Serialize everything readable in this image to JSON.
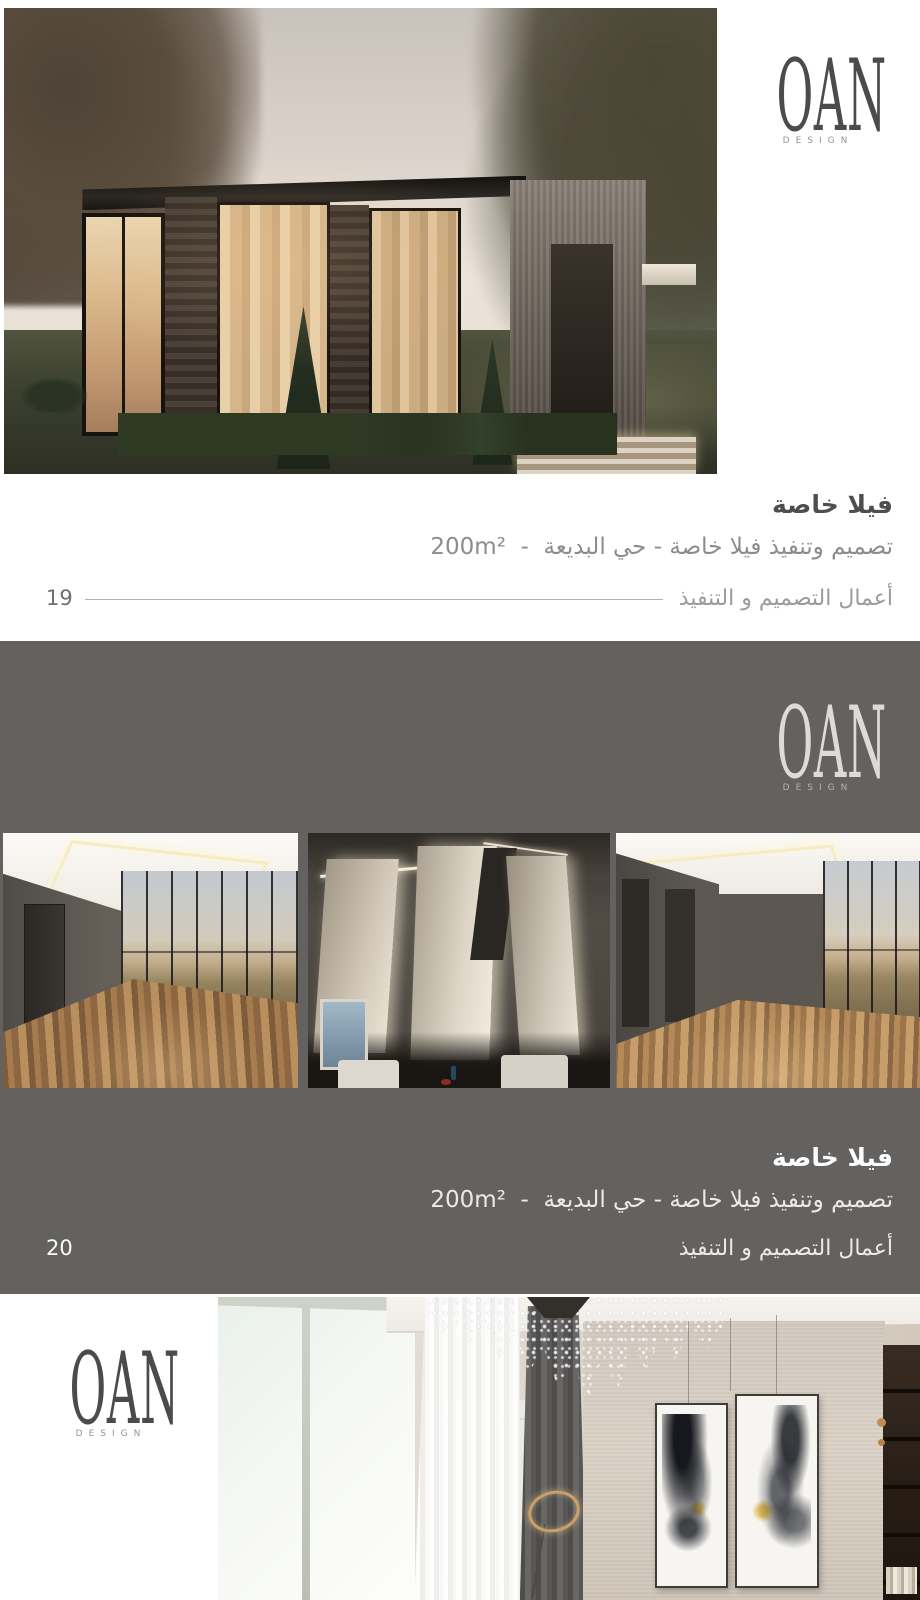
{
  "brand": {
    "name": "OAN",
    "tagline": "DESIGN"
  },
  "pages": {
    "p19": {
      "title": "فيلا خاصة",
      "subtitle": "تصميم وتنفيذ فيلا خاصة - حي البديعة  -  200m²",
      "footer": "أعمال التصميم و التنفيذ",
      "page_number": "19"
    },
    "p20": {
      "title": "فيلا خاصة",
      "subtitle": "تصميم وتنفيذ فيلا خاصة - حي البديعة  -  200m²",
      "footer": "أعمال التصميم و التنفيذ",
      "page_number": "20"
    }
  },
  "colors": {
    "page_bg": "#ffffff",
    "section_bg": "#636260",
    "logo_dark": "#4c4b49",
    "logo_light": "#dcdbd7",
    "title_dark": "#4f4e4c",
    "subtitle_dark_page": "#8d8c8a",
    "footer_dark_page": "#9c9b99",
    "rule": "#b1b0ae",
    "title_light": "#fdfdfd",
    "subtitle_light": "#eceae7",
    "page_number_dark": "#6f6e6c",
    "page_number_light": "#fbfbfa"
  }
}
